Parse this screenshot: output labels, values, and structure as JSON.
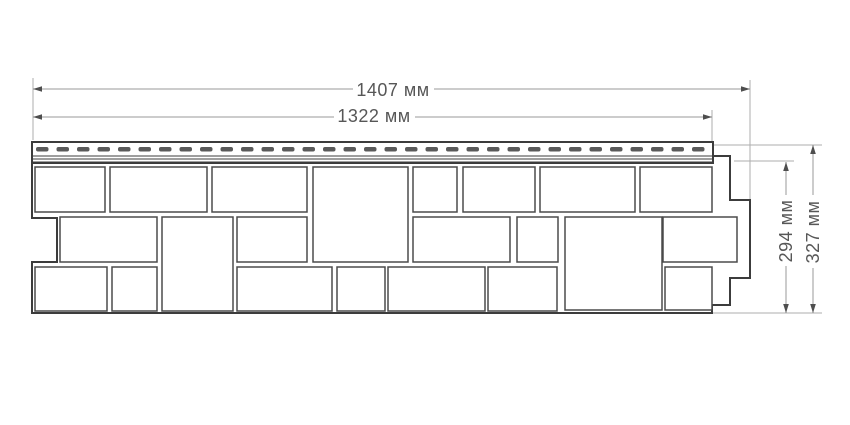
{
  "drawing": {
    "description": "Technical dimension drawing of a facade siding panel (stone/rock pattern) with nailing hem",
    "units": "мм",
    "colors": {
      "background": "#ffffff",
      "panel_outline": "#3c3c3c",
      "stone_border": "#4b4b4b",
      "dimension_line": "#9a9a9a",
      "extension_line": "#aeaeae",
      "arrow": "#4e4e4e",
      "text": "#575757",
      "slot": "#5a5a5a"
    },
    "labels": {
      "width_overall": "1407 мм",
      "width_hem": "1322 мм",
      "height_panel": "294 мм",
      "height_overall": "327 мм"
    },
    "dimensions": {
      "horizontal": [
        {
          "id": "width-overall",
          "label_key": "width_overall",
          "y": 89,
          "x1": 33,
          "x2": 750,
          "gap": [
            353,
            434
          ]
        },
        {
          "id": "width-hem",
          "label_key": "width_hem",
          "y": 117,
          "x1": 33,
          "x2": 712,
          "gap": [
            334,
            415
          ]
        }
      ],
      "vertical": [
        {
          "id": "height-panel",
          "label_key": "height_panel",
          "x": 786,
          "y1": 162,
          "y2": 313,
          "gap": [
            195,
            266
          ]
        },
        {
          "id": "height-overall",
          "label_key": "height_overall",
          "x": 813,
          "y1": 145,
          "y2": 313,
          "gap": [
            195,
            268
          ]
        }
      ]
    },
    "extension_lines": [
      {
        "x1": 33,
        "y1": 78,
        "x2": 33,
        "y2": 140
      },
      {
        "x1": 750,
        "y1": 80,
        "x2": 750,
        "y2": 199
      },
      {
        "x1": 712,
        "y1": 110,
        "x2": 712,
        "y2": 141
      },
      {
        "x1": 713,
        "y1": 145,
        "x2": 822,
        "y2": 145
      },
      {
        "x1": 734,
        "y1": 161,
        "x2": 794,
        "y2": 161
      },
      {
        "x1": 710,
        "y1": 313,
        "x2": 822,
        "y2": 313
      }
    ],
    "panel": {
      "outline_points": "32,163 713,163 713,156 730,156 730,200 750,200 750,278 730,278 730,305 712,305 712,313 32,313 32,262 57,262 57,218 32,218",
      "nail_hem": {
        "x": 32,
        "y": 142,
        "width": 681,
        "height": 21,
        "lines_y": [
          156,
          159,
          162
        ],
        "slots": {
          "y": 147,
          "height": 4.5,
          "width": 12.5,
          "gap": 8,
          "start_x": 36,
          "end_x": 706,
          "radius": 2
        }
      },
      "stones": [
        {
          "x": 35,
          "y": 167,
          "w": 70,
          "h": 45
        },
        {
          "x": 110,
          "y": 167,
          "w": 97,
          "h": 45
        },
        {
          "x": 212,
          "y": 167,
          "w": 95,
          "h": 45
        },
        {
          "x": 313,
          "y": 167,
          "w": 95,
          "h": 95
        },
        {
          "x": 413,
          "y": 167,
          "w": 44,
          "h": 45
        },
        {
          "x": 463,
          "y": 167,
          "w": 72,
          "h": 45
        },
        {
          "x": 540,
          "y": 167,
          "w": 95,
          "h": 45
        },
        {
          "x": 640,
          "y": 167,
          "w": 72,
          "h": 45
        },
        {
          "x": 60,
          "y": 217,
          "w": 97,
          "h": 45
        },
        {
          "x": 162,
          "y": 217,
          "w": 71,
          "h": 94
        },
        {
          "x": 237,
          "y": 217,
          "w": 70,
          "h": 45
        },
        {
          "x": 413,
          "y": 217,
          "w": 97,
          "h": 45
        },
        {
          "x": 517,
          "y": 217,
          "w": 41,
          "h": 45
        },
        {
          "x": 565,
          "y": 217,
          "w": 97,
          "h": 93
        },
        {
          "x": 663,
          "y": 217,
          "w": 74,
          "h": 45
        },
        {
          "x": 35,
          "y": 267,
          "w": 72,
          "h": 44
        },
        {
          "x": 112,
          "y": 267,
          "w": 45,
          "h": 44
        },
        {
          "x": 237,
          "y": 267,
          "w": 95,
          "h": 44
        },
        {
          "x": 337,
          "y": 267,
          "w": 48,
          "h": 44
        },
        {
          "x": 388,
          "y": 267,
          "w": 97,
          "h": 44
        },
        {
          "x": 488,
          "y": 267,
          "w": 69,
          "h": 44
        },
        {
          "x": 665,
          "y": 267,
          "w": 47,
          "h": 43
        }
      ]
    }
  }
}
